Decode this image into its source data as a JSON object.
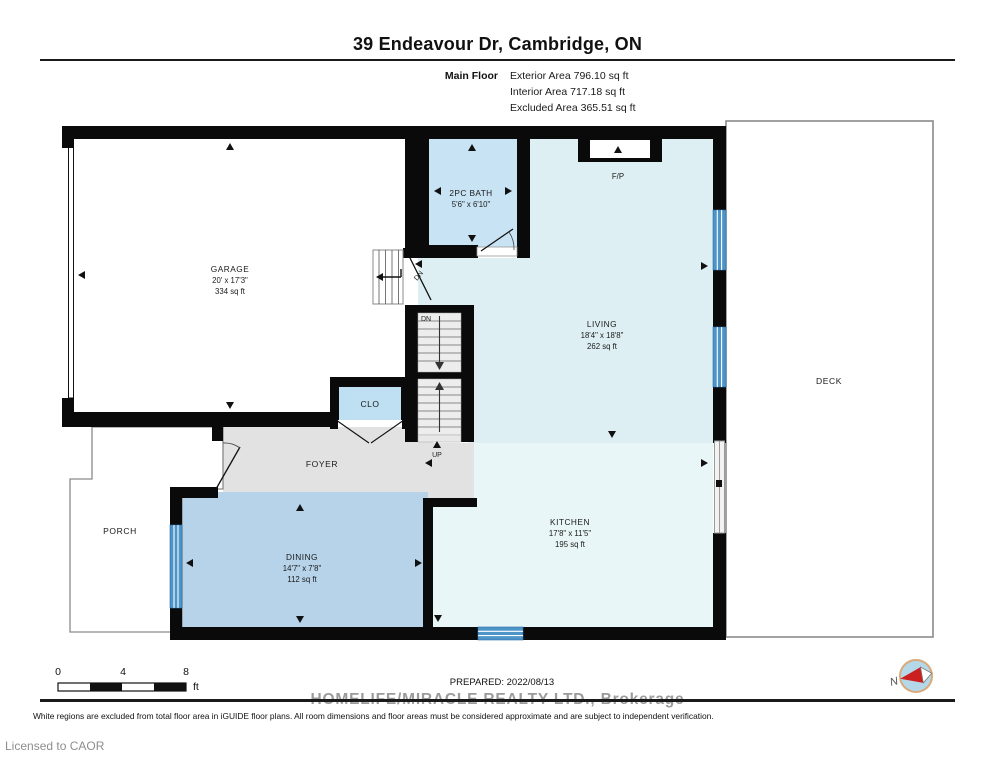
{
  "header": {
    "title": "39 Endeavour Dr, Cambridge, ON",
    "floor_label": "Main Floor",
    "areas": [
      "Exterior Area 796.10 sq ft",
      "Interior Area 717.18 sq ft",
      "Excluded Area 365.51 sq ft"
    ]
  },
  "rooms": {
    "garage": {
      "name": "GARAGE",
      "dims": "20' x 17'3\"",
      "area": "334 sq ft"
    },
    "bath": {
      "name": "2PC BATH",
      "dims": "5'6\" x 6'10\""
    },
    "living": {
      "name": "LIVING",
      "dims": "18'4\" x 18'8\"",
      "area": "262 sq ft"
    },
    "kitchen": {
      "name": "KITCHEN",
      "dims": "17'8\" x 11'5\"",
      "area": "195 sq ft"
    },
    "dining": {
      "name": "DINING",
      "dims": "14'7\" x 7'8\"",
      "area": "112 sq ft"
    },
    "foyer": {
      "name": "FOYER"
    },
    "porch": {
      "name": "PORCH"
    },
    "deck": {
      "name": "DECK"
    },
    "closet": {
      "name": "CLO"
    },
    "fireplace": {
      "name": "F/P"
    }
  },
  "stairs": {
    "dn_garage": "DN",
    "dn_main": "DN",
    "up": "UP"
  },
  "scale_bar": {
    "ticks": [
      "0",
      "4",
      "8"
    ],
    "unit": "ft"
  },
  "footer": {
    "prepared": "PREPARED: 2022/08/13",
    "brokerage": "HOMELIFE/MIRACLE REALTY LTD., Brokerage",
    "disclaimer": "White regions are excluded from total floor area in iGUIDE floor plans. All room dimensions and floor areas must be considered approximate and are subject to independent verification.",
    "license": "Licensed to CAOR",
    "compass_label": "N"
  },
  "colors": {
    "wall": "#0a0a0a",
    "living_fill": "#ddeff3",
    "kitchen_fill": "#e9f6f7",
    "bath_fill": "#c8e3f4",
    "closet_fill": "#bfdff2",
    "dining_fill": "#b7d3e9",
    "foyer_fill": "#e2e2e2",
    "window_blue": "#4d94c8",
    "compass_red": "#cc1f1f"
  }
}
